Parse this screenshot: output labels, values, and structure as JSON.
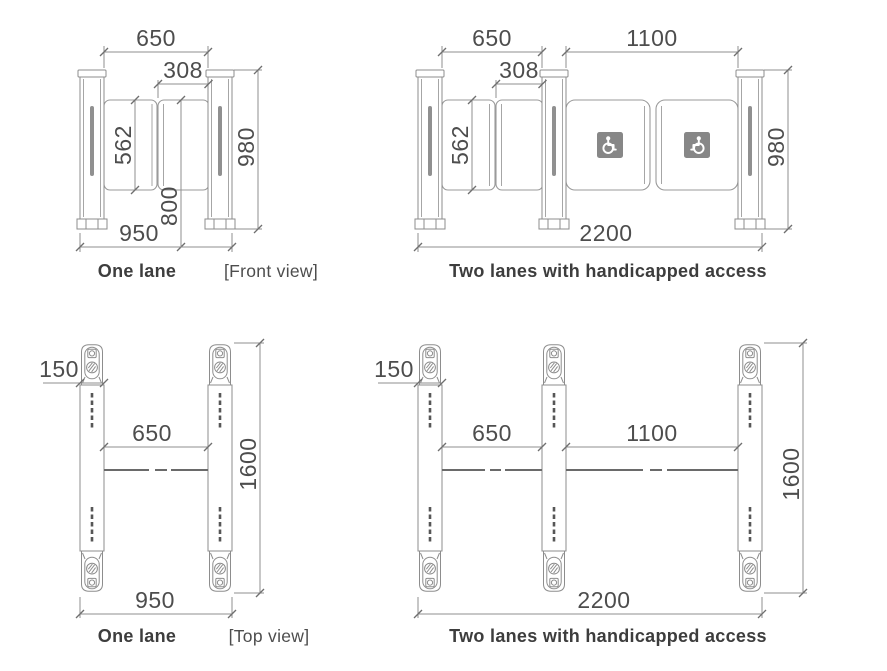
{
  "diagram_title": "Speed gate turnstile dimensional drawing",
  "views": {
    "front_one": {
      "caption": "One lane",
      "lane_width": "650",
      "door_width": "308",
      "glass_height": "562",
      "cabinet_height": "980",
      "door_top_height": "800",
      "overall_width": "950"
    },
    "front_two": {
      "caption": "Two lanes with handicapped access",
      "lane1_width": "650",
      "door_width": "308",
      "lane2_width": "1100",
      "glass_height": "562",
      "cabinet_height": "980",
      "overall_width": "2200"
    },
    "top_one": {
      "caption": "One lane",
      "cabinet_width": "150",
      "lane_width": "650",
      "cabinet_length": "1600",
      "overall_width": "950"
    },
    "top_two": {
      "caption": "Two lanes with handicapped access",
      "cabinet_width": "150",
      "lane1_width": "650",
      "lane2_width": "1100",
      "cabinet_length": "1600",
      "overall_width": "2200"
    },
    "view_labels": {
      "front": "[Front view]",
      "top": "[Top view]"
    }
  },
  "icons": {
    "handicap_left": "wheelchair-accessible",
    "handicap_right": "wheelchair-accessible-mirrored"
  },
  "colors": {
    "line": "#8d8d8d",
    "dimension_line": "#8f8f8f",
    "dimension_text": "#4d4d4d",
    "caption_text": "#3d3d3d",
    "icon_background": "#878787",
    "icon_symbol": "#ffffff"
  }
}
